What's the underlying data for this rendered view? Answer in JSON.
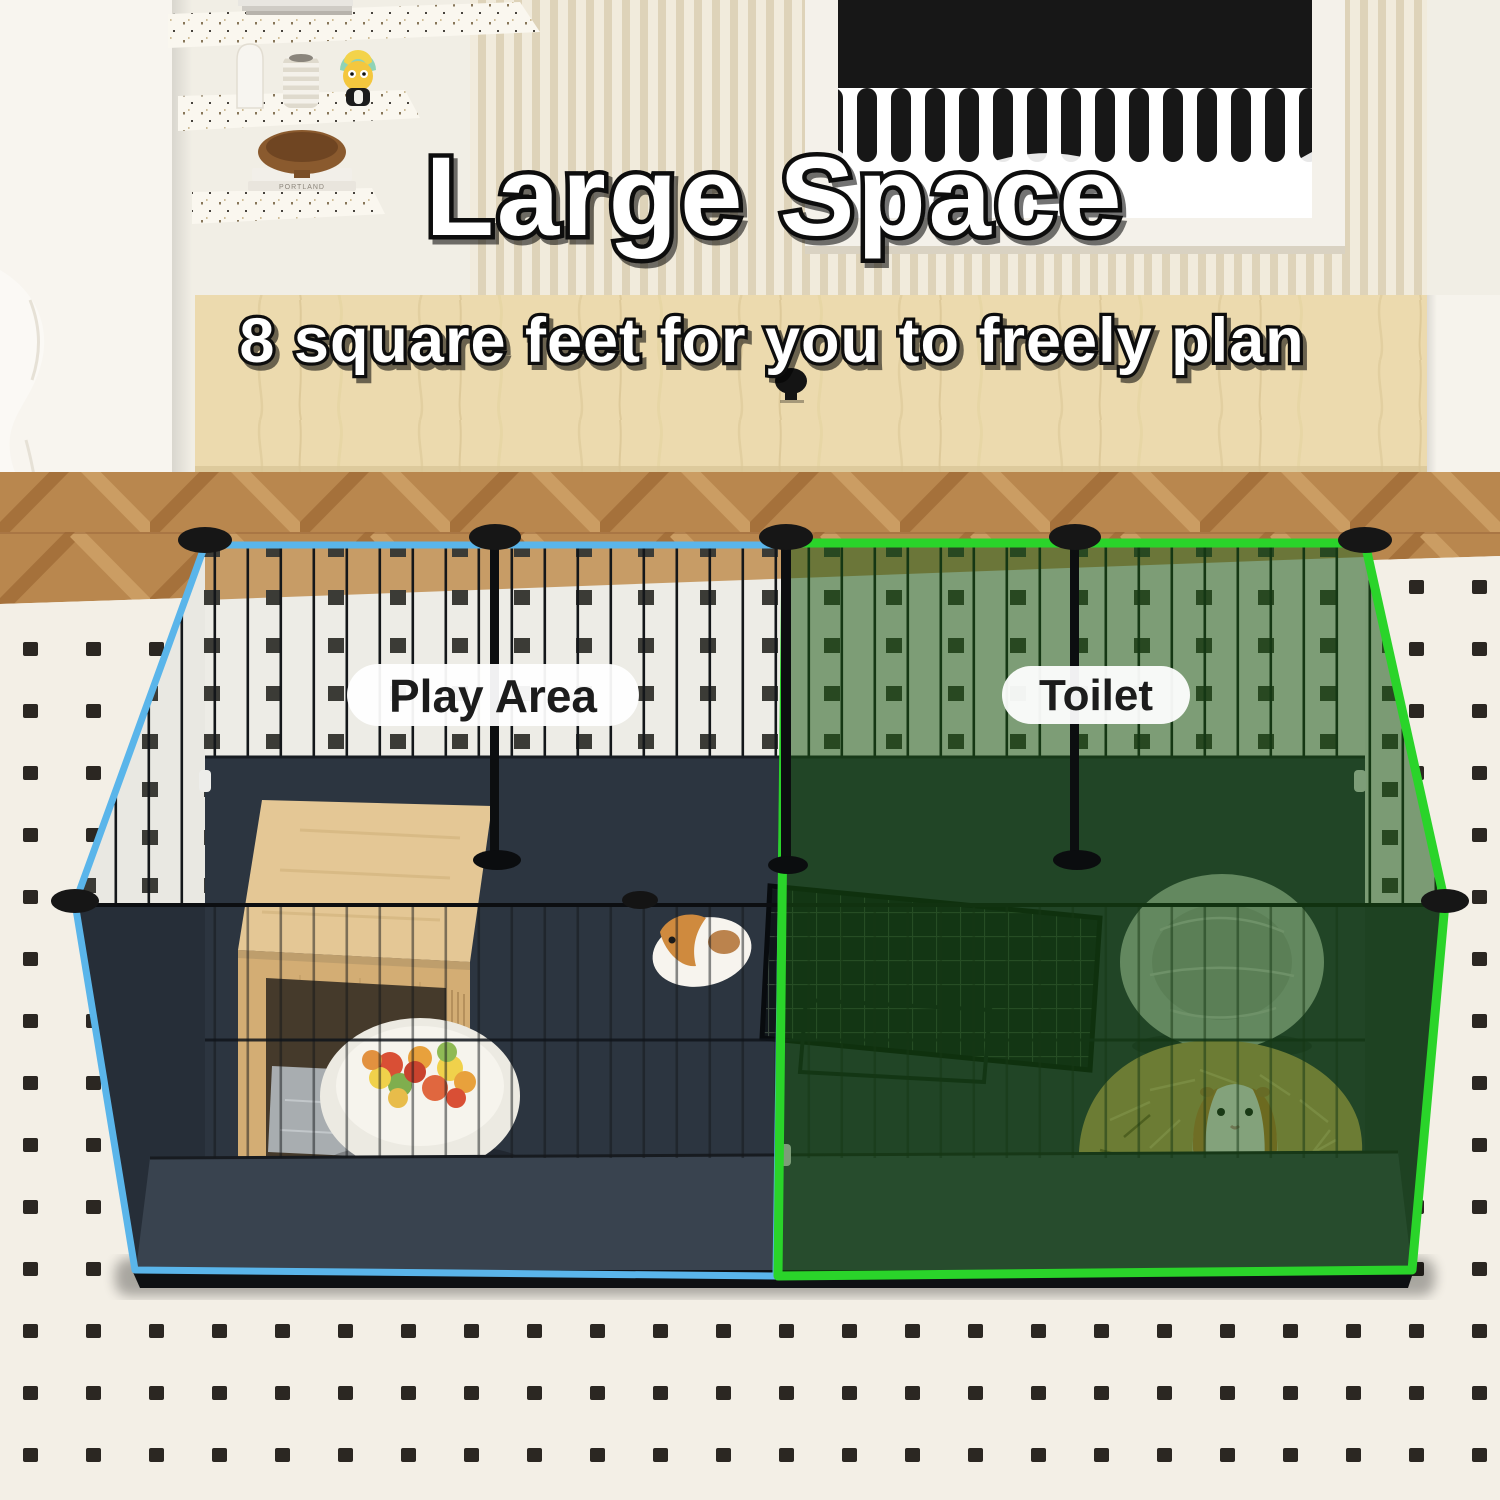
{
  "image_type": "product-marketing-photo",
  "headline": {
    "title": "Large Space",
    "subtitle": "8 square feet for you to freely plan"
  },
  "sections": {
    "play_area": {
      "label": "Play Area",
      "outline_color": "#5ab5ea"
    },
    "toilet": {
      "label": "Toilet",
      "outline_color": "#2ad42a",
      "tint_color": "#175510"
    }
  },
  "decor": {
    "book_spine_text": "PORTLAND"
  },
  "palette": {
    "wall": "#f1eee5",
    "wood_panel": "#ecdaae",
    "floor": "#b9874e",
    "rug": "#f3efe6",
    "rug_dot": "#2b2722",
    "pen_interior": "#2c3540",
    "mesh_background": "#edece6",
    "text_fill": "#ffffff",
    "text_outline": "#101010"
  }
}
